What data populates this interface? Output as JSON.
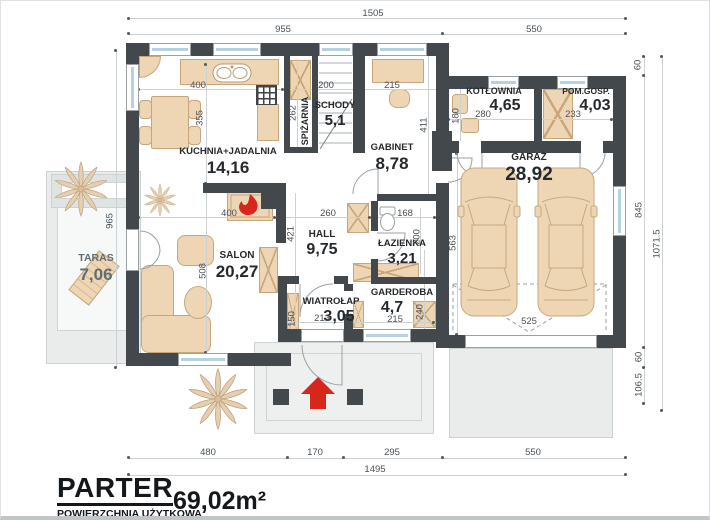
{
  "title": {
    "floor_label": "PARTER",
    "area_caption": "POWIERZCHNIA UŻYTKOWA",
    "area_value": "69,02m²"
  },
  "rooms": {
    "kuchnia_jadalnia": {
      "name": "KUCHNIA+JADALNIA",
      "area": "14,16"
    },
    "spizarnia": {
      "name": "SPIŻARNIA"
    },
    "schody": {
      "name": "SCHODY",
      "area": "5,1"
    },
    "gabinet": {
      "name": "GABINET",
      "area": "8,78"
    },
    "kotlownia": {
      "name": "KOTŁOWNIA",
      "area": "4,65"
    },
    "pom_gosp": {
      "name": "POM.GOSP.",
      "area": "4,03"
    },
    "garaz": {
      "name": "GARAŻ",
      "area": "28,92"
    },
    "salon": {
      "name": "SALON",
      "area": "20,27"
    },
    "hall": {
      "name": "HALL",
      "area": "9,75"
    },
    "lazienka": {
      "name": "ŁAZIENKA",
      "area": "3,21"
    },
    "wiatrolap": {
      "name": "WIATROŁAP",
      "area": "3,05"
    },
    "garderoba": {
      "name": "GARDEROBA",
      "area": "4,7"
    },
    "taras": {
      "name": "TARAS",
      "area": "7,06"
    }
  },
  "dimensions": {
    "top_total": "1505",
    "top_left": "955",
    "top_right": "550",
    "bottom_salon": "480",
    "bottom_entry": "170",
    "bottom_garderoba": "295",
    "bottom_garage": "550",
    "bottom_total": "1495",
    "right_top": "60",
    "right_garage": "845",
    "right_step": "60",
    "right_apron": "106.5",
    "right_total": "1071.5",
    "left_taras": "965",
    "kitchen_top": "400",
    "kitchen_depth": "355",
    "kitchen_bottom": "400",
    "spizarnia_depth": "262",
    "spizarnia_width": "200",
    "gabinet_width": "215",
    "gabinet_depth": "411",
    "kotlownia_width": "280",
    "kotlownia_depth": "180",
    "pom_gosp_width": "233",
    "garaz_depth": "563",
    "garaz_door": "525",
    "hall_width": "260",
    "hall_depth": "421",
    "salon_depth": "508",
    "lazienka_width": "168",
    "lazienka_depth": "200",
    "wiatrolap_width": "213",
    "wiatrolap_depth": "150",
    "garderoba_width": "215",
    "garderoba_depth": "240"
  },
  "colors": {
    "wall": "#43484c",
    "accent_red": "#d8261c",
    "furniture": "#eed6b5",
    "paving": "#e9eceb",
    "glass": "#b5d2e0"
  }
}
